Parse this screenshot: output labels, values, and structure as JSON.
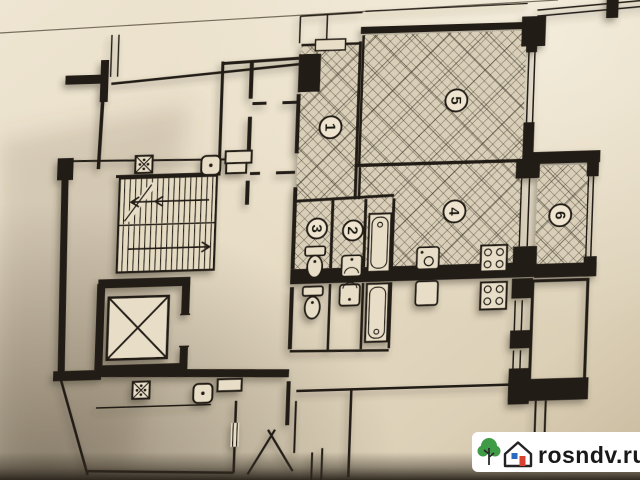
{
  "page": {
    "kind": "floor-plan-photo"
  },
  "plan": {
    "rooms": [
      {
        "number": "1",
        "hatched": true
      },
      {
        "number": "2",
        "hatched": true
      },
      {
        "number": "3",
        "hatched": true
      },
      {
        "number": "4",
        "hatched": true
      },
      {
        "number": "5",
        "hatched": true
      },
      {
        "number": "6",
        "hatched": true
      }
    ],
    "icons": [
      "staircase",
      "stair-direction-arrow",
      "elevator-shaft",
      "ventilation-shaft",
      "garbage-chute",
      "toilet",
      "wash-basin",
      "bathtub",
      "kitchen-sink",
      "stove",
      "window",
      "door-opening",
      "balcony"
    ]
  },
  "watermark": {
    "site": "rosndv.ru",
    "logo": [
      "tree-icon",
      "house-icon"
    ],
    "box_color": "#ffffff",
    "text_color": "#191919",
    "tree_color": "#3f9b45",
    "door_color": "#d8402f",
    "window_color": "#2b6bbf"
  },
  "colors": {
    "paper": "#e8ddc6",
    "ink": "#211c15",
    "paper_shadow": "#c7b99e",
    "photo_edge": "#3a3328"
  }
}
